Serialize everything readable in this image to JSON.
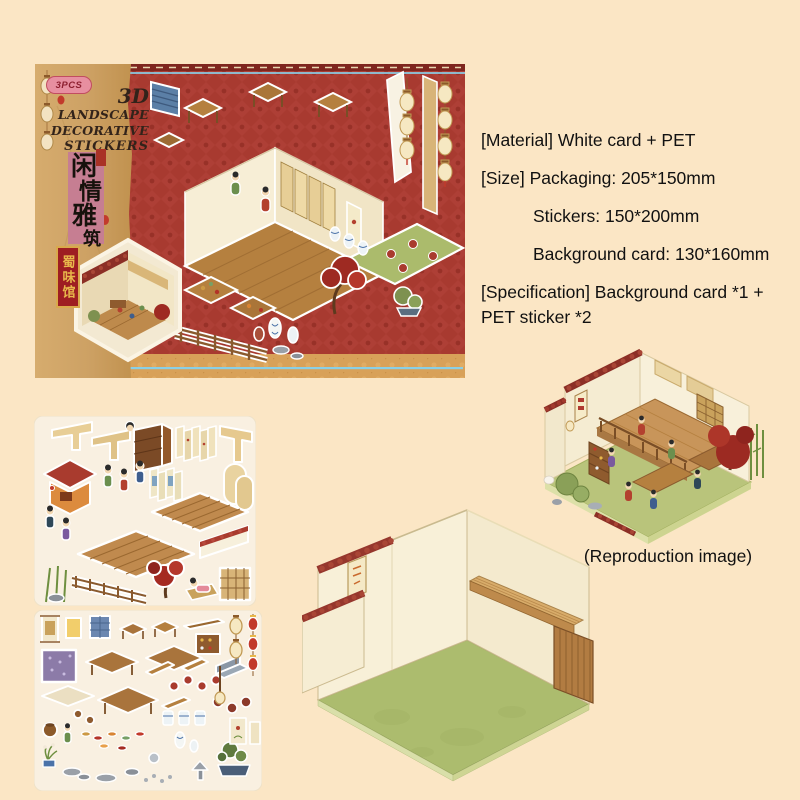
{
  "page": {
    "background_color": "#FBE6C5"
  },
  "package": {
    "badge_label": "3PCS",
    "title_lines": [
      "3D",
      "LANDSCAPE",
      "DECORATIVE",
      "STICKERS"
    ],
    "chinese_title": "闲情雅筑",
    "chinese_title_chars": [
      "闲",
      "情",
      "雅",
      "筑"
    ],
    "shop_sign": "蜀味馆"
  },
  "specs": {
    "material": "[Material] White card + PET",
    "size_packaging": "[Size] Packaging: 205*150mm",
    "size_stickers": "Stickers: 150*200mm",
    "size_background_card": "Background card: 130*160mm",
    "specification_line1": "[Specification] Background card *1 +",
    "specification_line2": "PET sticker *2"
  },
  "reproduction": {
    "caption": "(Reproduction image)"
  },
  "colors": {
    "package_red": "#A83A30",
    "kraft": "#CDA164",
    "pink_title_box": "#C67E92",
    "banner_red": "#9E1E22",
    "banner_gold": "#E8B84B",
    "accent_blue": "#8ACFE6",
    "floor_green": "#ACBC6E",
    "wall_cream": "#F7EFD9",
    "wood": "#B5803F",
    "roof_tile_red": "#96372D"
  }
}
